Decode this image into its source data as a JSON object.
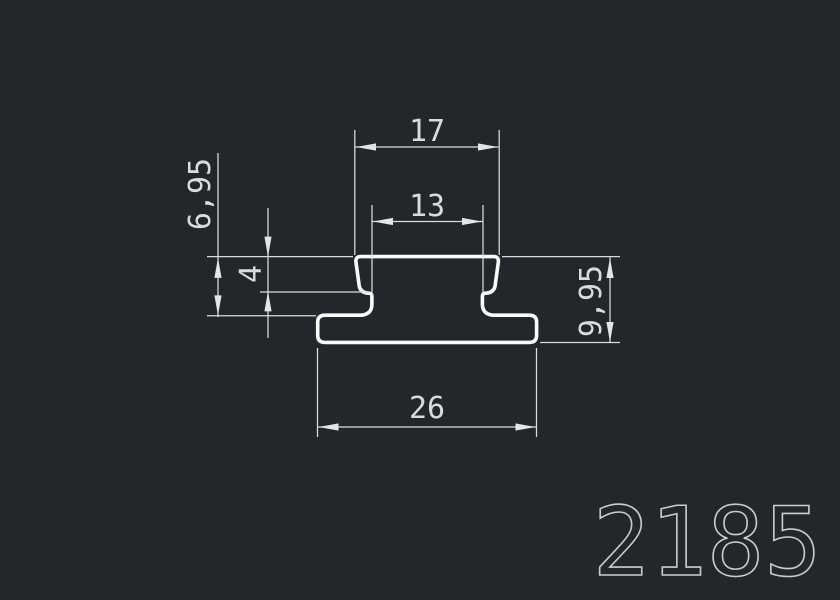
{
  "drawing": {
    "part_number": "2185",
    "type": "extrusion-profile-cross-section",
    "dimensions": {
      "top_width": "17",
      "slot_width": "13",
      "step_height": "4",
      "upper_height": "6,95",
      "total_height": "9,95",
      "base_width": "26"
    },
    "colors": {
      "background": "#23272c",
      "profile_line": "#f8f9fa",
      "dimension_line": "#d9dcde",
      "part_number_stroke": "#c9ccce"
    }
  }
}
